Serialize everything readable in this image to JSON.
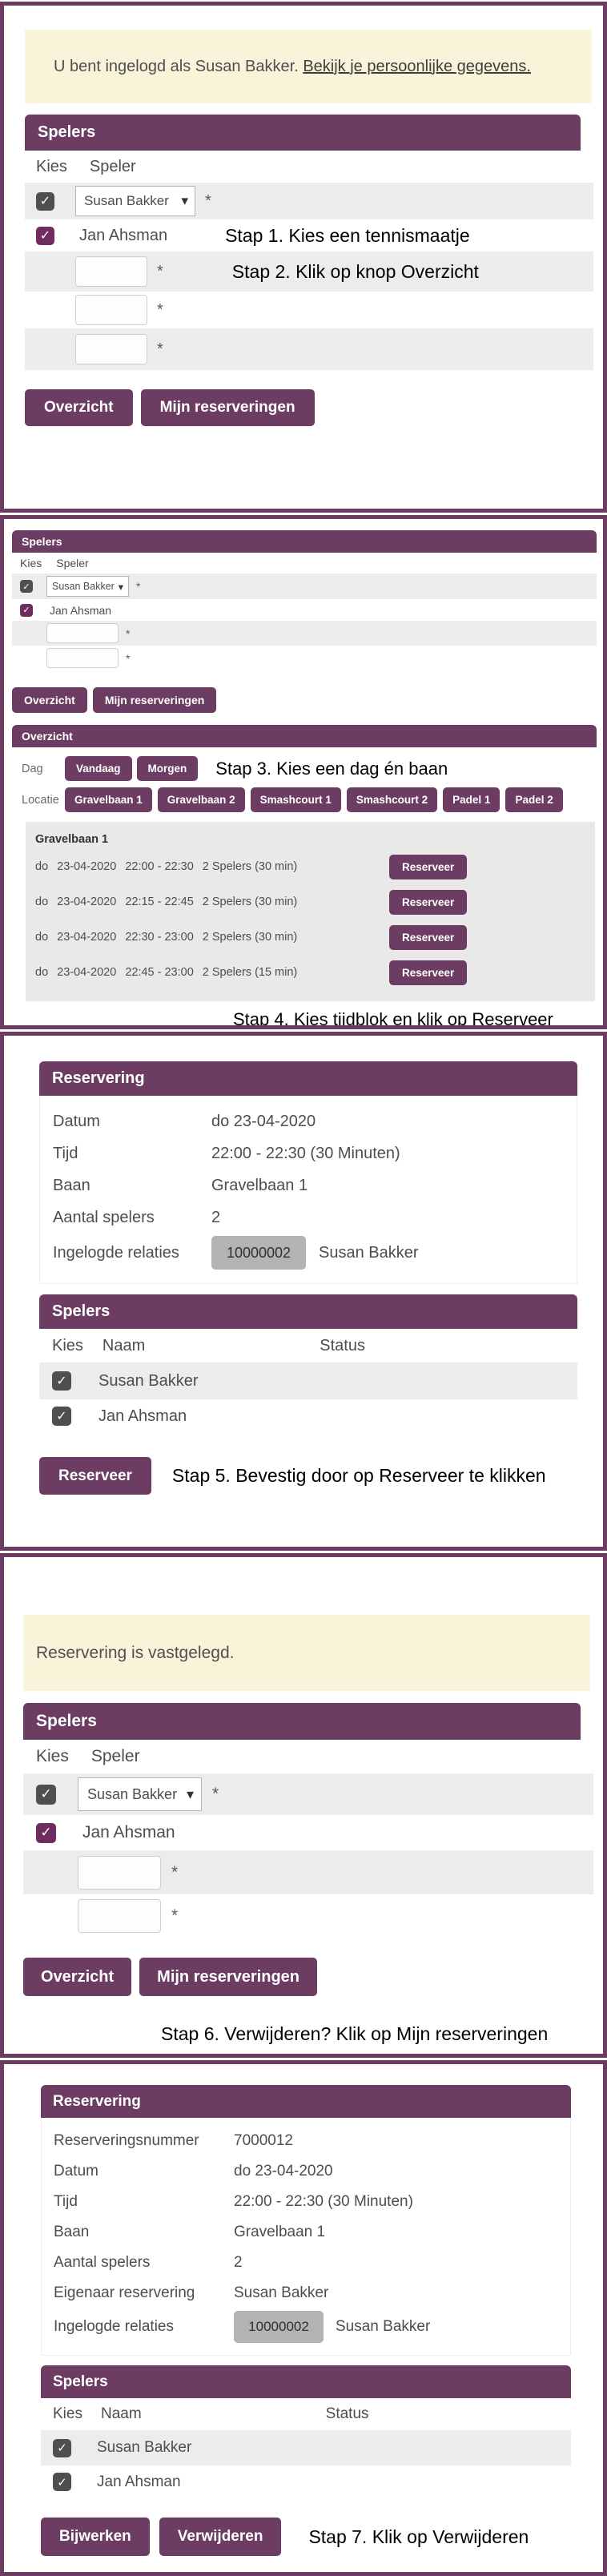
{
  "ui": {
    "star": "*",
    "caret": "▾",
    "check": "✓"
  },
  "colors": {
    "purple": "#6d3c62",
    "checkbox_purple": "#702c5f",
    "checkbox_gray": "#4f4f4f",
    "banner_bg": "#f9f3d9",
    "row_gray": "#ececec",
    "block_gray": "#e9e9e9",
    "badge_gray": "#b3b3b3"
  },
  "p1": {
    "banner_text": "U bent ingelogd als Susan Bakker.",
    "banner_link": "Bekijk je persoonlijke gegevens.",
    "spelers_title": "Spelers",
    "col_kies": "Kies",
    "col_speler": "Speler",
    "player1": "Susan Bakker",
    "player2": "Jan Ahsman",
    "step1": "Stap 1. Kies een tennismaatje",
    "step2": "Stap 2. Klik op knop Overzicht",
    "btn_overzicht": "Overzicht",
    "btn_mijn": "Mijn reserveringen"
  },
  "p2": {
    "spelers_title": "Spelers",
    "col_kies": "Kies",
    "col_speler": "Speler",
    "player1": "Susan Bakker",
    "player2": "Jan Ahsman",
    "btn_overzicht": "Overzicht",
    "btn_mijn": "Mijn reserveringen",
    "overzicht_title": "Overzicht",
    "dag_label": "Dag",
    "btn_vandaag": "Vandaag",
    "btn_morgen": "Morgen",
    "step3": "Stap 3. Kies een dag én baan",
    "locatie_label": "Locatie",
    "courts": [
      "Gravelbaan 1",
      "Gravelbaan 2",
      "Smashcourt 1",
      "Smashcourt 2",
      "Padel 1",
      "Padel 2"
    ],
    "court_title": "Gravelbaan 1",
    "slots": [
      {
        "day": "do",
        "date": "23-04-2020",
        "time": "22:00 - 22:30",
        "info": "2 Spelers (30 min)",
        "button": "Reserveer"
      },
      {
        "day": "do",
        "date": "23-04-2020",
        "time": "22:15 - 22:45",
        "info": "2 Spelers (30 min)",
        "button": "Reserveer"
      },
      {
        "day": "do",
        "date": "23-04-2020",
        "time": "22:30 - 23:00",
        "info": "2 Spelers (30 min)",
        "button": "Reserveer"
      },
      {
        "day": "do",
        "date": "23-04-2020",
        "time": "22:45 - 23:00",
        "info": "2 Spelers (15 min)",
        "button": "Reserveer"
      }
    ],
    "step4": "Stap 4. Kies tijdblok en klik op Reserveer"
  },
  "p3": {
    "reservering_title": "Reservering",
    "fields": [
      {
        "label": "Datum",
        "value": "do 23-04-2020"
      },
      {
        "label": "Tijd",
        "value": "22:00 - 22:30 (30 Minuten)"
      },
      {
        "label": "Baan",
        "value": "Gravelbaan 1"
      },
      {
        "label": "Aantal spelers",
        "value": "2"
      }
    ],
    "relaties_label": "Ingelogde relaties",
    "relaties_badge": "10000002",
    "relaties_name": "Susan Bakker",
    "spelers_title": "Spelers",
    "col_kies": "Kies",
    "col_naam": "Naam",
    "col_status": "Status",
    "player1": "Susan Bakker",
    "player2": "Jan Ahsman",
    "btn_reserveer": "Reserveer",
    "step5": "Stap 5. Bevestig door op Reserveer te klikken"
  },
  "p4": {
    "banner_text": "Reservering is vastgelegd.",
    "spelers_title": "Spelers",
    "col_kies": "Kies",
    "col_speler": "Speler",
    "player1": "Susan Bakker",
    "player2": "Jan Ahsman",
    "btn_overzicht": "Overzicht",
    "btn_mijn": "Mijn reserveringen",
    "step6": "Stap 6. Verwijderen? Klik op Mijn reserveringen"
  },
  "p5": {
    "reservering_title": "Reservering",
    "fields": [
      {
        "label": "Reserveringsnummer",
        "value": "7000012"
      },
      {
        "label": "Datum",
        "value": "do 23-04-2020"
      },
      {
        "label": "Tijd",
        "value": "22:00 - 22:30 (30 Minuten)"
      },
      {
        "label": "Baan",
        "value": "Gravelbaan 1"
      },
      {
        "label": "Aantal spelers",
        "value": "2"
      },
      {
        "label": "Eigenaar reservering",
        "value": "Susan Bakker"
      }
    ],
    "relaties_label": "Ingelogde relaties",
    "relaties_badge": "10000002",
    "relaties_name": "Susan Bakker",
    "spelers_title": "Spelers",
    "col_kies": "Kies",
    "col_naam": "Naam",
    "col_status": "Status",
    "player1": "Susan Bakker",
    "player2": "Jan Ahsman",
    "btn_bijwerken": "Bijwerken",
    "btn_verwijderen": "Verwijderen",
    "step7": "Stap 7. Klik op Verwijderen"
  }
}
